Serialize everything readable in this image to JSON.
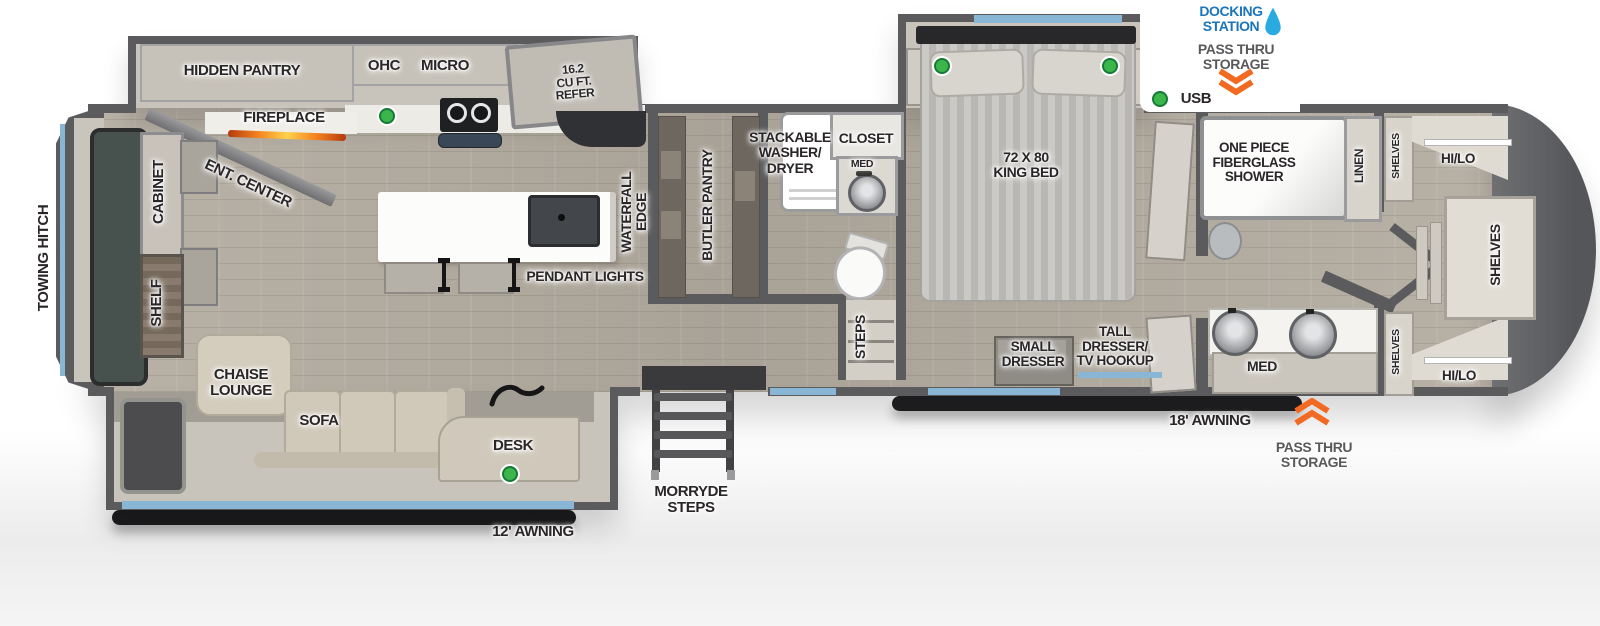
{
  "colors": {
    "wall": "#5b5b5d",
    "floor_wood": "#b5aea3",
    "slide_floor": "#c9c4bb",
    "furniture_beige": "#cfc8ba",
    "window_blue": "#8ab6d6",
    "indicator_green": "#3cb54b",
    "docking_blue": "#1b75bb",
    "droplet_blue": "#29abe2",
    "chevron_orange": "#f26a21",
    "awning_black": "#1c1c1e",
    "label_text": "#2a2628"
  },
  "exterior": {
    "towing_hitch": "TOWING HITCH",
    "docking_station": [
      "DOCKING",
      "STATION"
    ],
    "pass_thru_top": [
      "PASS THRU",
      "STORAGE"
    ],
    "usb_label": "USB",
    "awning_18": "18' AWNING",
    "pass_thru_bottom": [
      "PASS THRU",
      "STORAGE"
    ],
    "morryde_steps": [
      "MORRYDE",
      "STEPS"
    ],
    "awning_12": "12' AWNING"
  },
  "front": {
    "cabinet": "CABINET",
    "shelf": "SHELF",
    "ent_center": "ENT. CENTER"
  },
  "kitchen": {
    "hidden_pantry": "HIDDEN PANTRY",
    "fireplace": "FIREPLACE",
    "ohc": "OHC",
    "micro": "MICRO",
    "refer": [
      "16.2",
      "CU FT.",
      "REFER"
    ],
    "waterfall_edge": [
      "WATERFALL",
      "EDGE"
    ],
    "pendant_lights": "PENDANT LIGHTS",
    "butler_pantry": "BUTLER PANTRY"
  },
  "living": {
    "chaise_lounge": [
      "CHAISE",
      "LOUNGE"
    ],
    "sofa": "SOFA",
    "desk": "DESK"
  },
  "mid_bath": {
    "washer_dryer": [
      "STACKABLE",
      "WASHER/",
      "DRYER"
    ],
    "closet": "CLOSET",
    "med": "MED",
    "steps": "STEPS"
  },
  "bedroom": {
    "king_bed": [
      "72 X 80",
      "KING BED"
    ],
    "small_dresser": [
      "SMALL",
      "DRESSER"
    ],
    "tall_dresser": [
      "TALL",
      "DRESSER/",
      "TV HOOKUP"
    ]
  },
  "rear_bath": {
    "shower": [
      "ONE PIECE",
      "FIBERGLASS",
      "SHOWER"
    ],
    "linen": "LINEN",
    "med": "MED"
  },
  "rear_closet": {
    "shelves_top": "SHELVES",
    "hilo_top": "HI/LO",
    "shelves_main": "SHELVES",
    "shelves_bottom": "SHELVES",
    "hilo_bottom": "HI/LO"
  }
}
